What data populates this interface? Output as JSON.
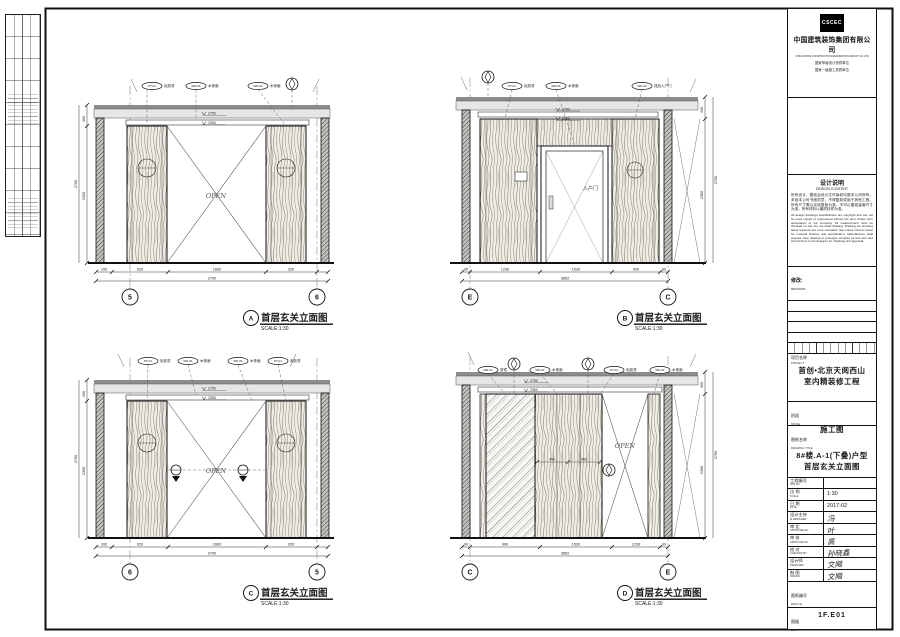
{
  "company": {
    "logo": "CSCEC",
    "name_cn": "中国建筑装饰集团有限公司",
    "name_en": "CHINA STATE CONSTRUCTION DECORATION GROUP CO.,LTD",
    "qual1": "国家甲级设计资质单位",
    "qual2": "国家一级施工资质单位"
  },
  "notes": {
    "title_cn": "设计说明",
    "title_en": "DESIGN CONTENT",
    "body_cn": "所有设计、图纸及设计文件版权均属本公司所有，未经本公司书面同意，不得复制或用于其他工程。所有尺寸需以实地复核为准，不可以图纸量度尺寸为准，所有材料以最终封样为准。",
    "body_en": "All design drawings specifications are copyright and can not be used copied or reproduced without the prior written form acceptance of our company. All measurement must be checked on site. Do not scale drawing. Drawing too showing latest revisions are to be cancelled. See colour scheme sheet for material finishes and specification. Manufacturer shall prepare shop drawing or prototype samples for this item and submit them to the designer for checking and approval."
  },
  "revision": {
    "cn": "修改:",
    "en": "REVISION"
  },
  "project": {
    "cn": "项目名称",
    "en": "PROJECT",
    "line1": "首创•北京天阅西山",
    "line2": "室内精装修工程"
  },
  "stage": {
    "cn": "阶段",
    "en": "STAGE",
    "value": "施工图"
  },
  "dtitle": {
    "cn": "图纸名称",
    "en": "DRAWING TITLE",
    "line1": "8#楼.A-1(下叠)户型",
    "line2": "首层玄关立面图"
  },
  "info": {
    "job": {
      "cn": "工程编号",
      "en": "JOB NO",
      "value": ""
    },
    "scale": {
      "cn": "比 例",
      "en": "SCALE",
      "value": "1:30"
    },
    "date": {
      "cn": "日 期",
      "en": "DATE",
      "value": "2017-02"
    },
    "lead": {
      "cn": "设计主持",
      "en": "M.DESIGNER",
      "value": "冯"
    },
    "approved": {
      "cn": "审 定",
      "en": "APPROVED BY",
      "value": "叶"
    },
    "reviewed": {
      "cn": "审 核",
      "en": "APPROVED BY",
      "value": "高"
    },
    "checked": {
      "cn": "校 对",
      "en": "CHECKED BY",
      "value": "孙晓鑫"
    },
    "designer": {
      "cn": "设计师",
      "en": "DESIGNER",
      "value": "文飚"
    },
    "drawn": {
      "cn": "制 图",
      "en": "DRAWN",
      "value": "文飚"
    }
  },
  "dwg_no": {
    "cn": "图纸编号",
    "en": "DWG No.",
    "value": "1F.E01"
  },
  "size_box": {
    "cn": "图幅",
    "en": "Size"
  },
  "drawings": {
    "a": {
      "letter": "A",
      "title": "首层玄关立面图",
      "scale": "SCALE:1:30",
      "open": "OPEN",
      "bubble_left": "5",
      "bubble_right": "6",
      "level_upper": "2750",
      "level_lower": "2350",
      "dims": [
        "100",
        "620",
        "1660",
        "320"
      ],
      "total": "2700",
      "vdims": [
        "400",
        "2350"
      ],
      "vtotal": "2750",
      "tags": [
        {
          "code": "PT-01",
          "label": "乳胶漆"
        },
        {
          "code": "WD-01",
          "label": "木饰面"
        },
        {
          "code": "WD-01",
          "label": "木饰面"
        }
      ]
    },
    "b": {
      "letter": "B",
      "title": "首层玄关立面图",
      "scale": "SCALE:1:30",
      "door": "入户门",
      "bubble_left": "E",
      "bubble_right": "C",
      "level_upper": "2750",
      "level_lower": "2350",
      "dims": [
        "90",
        "1236",
        "1530",
        "906",
        "90"
      ],
      "total": "3852",
      "vdims": [
        "400",
        "2350"
      ],
      "vtotal": "2750",
      "tags": [
        {
          "code": "PT-01",
          "label": "乳胶漆"
        },
        {
          "code": "WD-01",
          "label": "木饰面"
        },
        {
          "code": "WD-02",
          "label": "成品入户门"
        }
      ]
    },
    "c": {
      "letter": "C",
      "title": "首层玄关立面图",
      "scale": "SCALE:1:30",
      "open": "OPEN",
      "bubble_left": "6",
      "bubble_right": "5",
      "level_upper": "2750",
      "level_lower": "2350",
      "dims": [
        "320",
        "1660",
        "620",
        "100"
      ],
      "total": "2700",
      "vdims": [
        "400",
        "2350"
      ],
      "vtotal": "2750",
      "tags": [
        {
          "code": "PT-01",
          "label": "乳胶漆"
        },
        {
          "code": "WD-01",
          "label": "木饰面"
        },
        {
          "code": "WD-01",
          "label": "木饰面"
        },
        {
          "code": "PT-01",
          "label": "乳胶漆"
        }
      ]
    },
    "d": {
      "letter": "D",
      "title": "首层玄关立面图",
      "scale": "SCALE:1:30",
      "open": "OPEN",
      "bubble_left": "C",
      "bubble_right": "E",
      "level_upper": "2750",
      "level_lower": "2350",
      "dims": [
        "90",
        "906",
        "1530",
        "1236",
        "90"
      ],
      "total": "3852",
      "panel_dims": [
        "450",
        "450"
      ],
      "vdims": [
        "400",
        "2350"
      ],
      "vtotal": "2750",
      "tags": [
        {
          "code": "MR-01",
          "label": "茶镜"
        },
        {
          "code": "WD-01",
          "label": "木饰面"
        },
        {
          "code": "PT-01",
          "label": "乳胶漆"
        },
        {
          "code": "WD-01",
          "label": "木饰面"
        }
      ]
    }
  }
}
